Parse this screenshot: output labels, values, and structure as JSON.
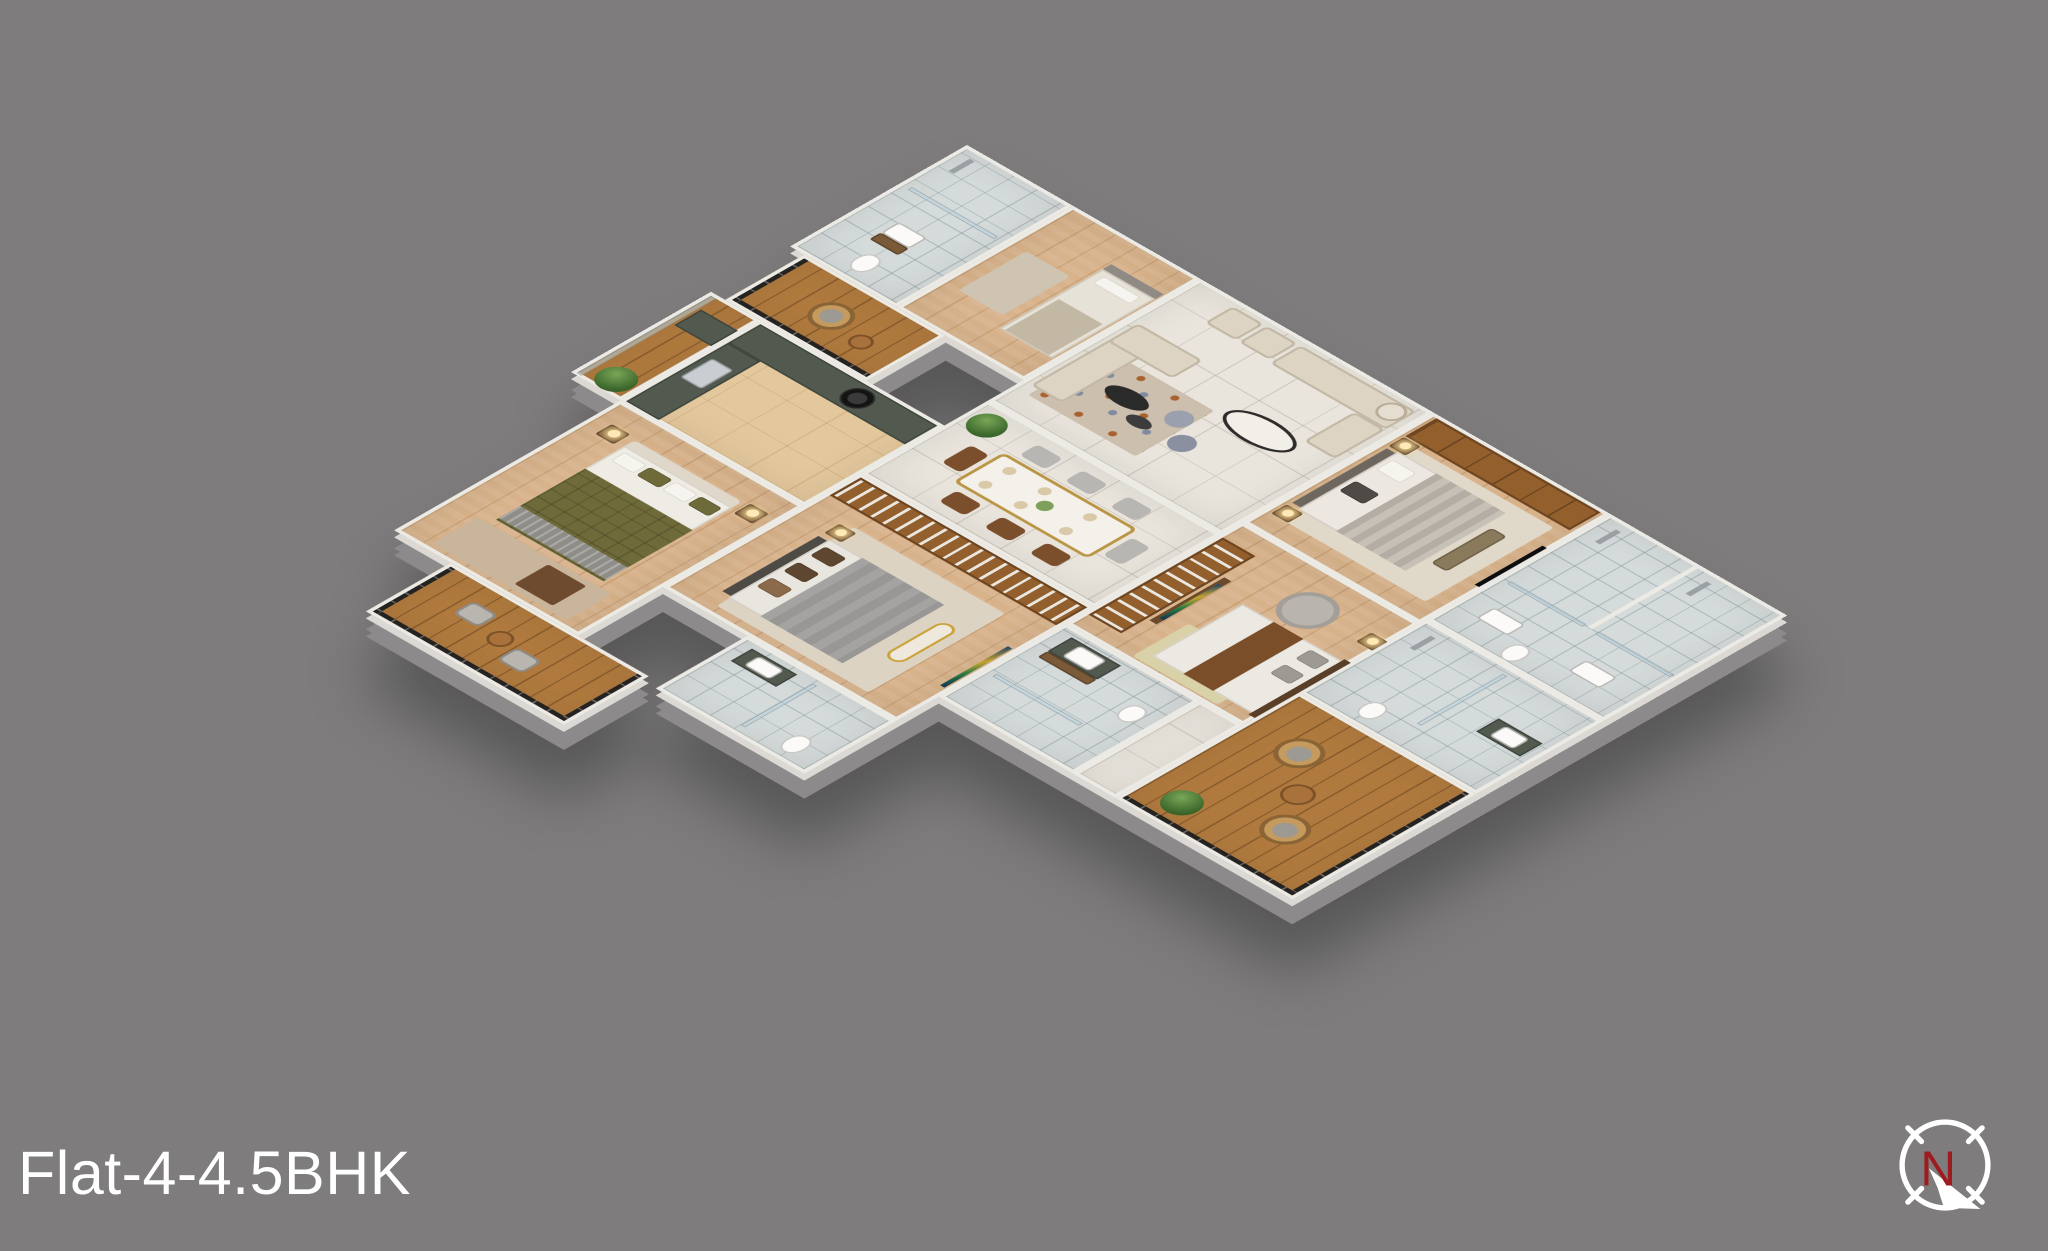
{
  "canvas": {
    "width": 2048,
    "height": 1251,
    "background": "#7e7c7d"
  },
  "title": {
    "text": "Flat-4-4.5BHK",
    "color": "#ffffff"
  },
  "compass": {
    "label": "N",
    "label_color": "#9e1b20",
    "ring_color": "#ffffff",
    "arrow_direction": "south-east"
  },
  "palette": {
    "wall": "#eceae5",
    "slab_edge": "#8d8a8c",
    "marble_floor": "#e9e5dd",
    "bathroom_tile": "#d5dbdb",
    "bedroom_wood": "#d7b28a",
    "balcony_deck": "#b07a3e",
    "kitchen_marble": "#e4c89d",
    "wardrobe_wood": "#935f2c",
    "granite_counter": "#525a50",
    "sofa_cream": "#ddd4c4",
    "accent_orange": "#a8622f",
    "olive_duvet": "#6f6a39",
    "gray_duvet": "#a4a3a1",
    "railing": "#242322"
  },
  "scene": {
    "type": "isometric-3d-floor-plan",
    "rooms": [
      {
        "id": "bathroom-1",
        "floor": "tile",
        "features": [
          "shower",
          "washbasin",
          "toilet"
        ]
      },
      {
        "id": "maid-room",
        "floor": "wood",
        "features": [
          "single-bed"
        ]
      },
      {
        "id": "sitout-balcony",
        "floor": "deck",
        "features": [
          "rattan-chair",
          "round-table",
          "black-railing"
        ]
      },
      {
        "id": "living-room",
        "floor": "marble",
        "features": [
          "sofa-set",
          "oval-coffee-table",
          "poufs",
          "rug",
          "armchairs"
        ]
      },
      {
        "id": "bedroom-1",
        "floor": "wood",
        "features": [
          "wardrobe",
          "double-bed",
          "bench",
          "nightstands",
          "tv"
        ]
      },
      {
        "id": "bathroom-2",
        "floor": "tile",
        "features": [
          "two-stalls",
          "showers",
          "washbasins",
          "toilet"
        ]
      },
      {
        "id": "utility-balcony",
        "floor": "deck",
        "features": [
          "granite-counter",
          "glass-rail"
        ]
      },
      {
        "id": "kitchen",
        "floor": "kitchen-marble",
        "features": [
          "l-counter",
          "gas-hob",
          "sink"
        ]
      },
      {
        "id": "dining",
        "floor": "marble",
        "features": [
          "eight-seat-table",
          "place-settings",
          "potted-plant"
        ]
      },
      {
        "id": "bedroom-2",
        "floor": "wood",
        "features": [
          "walk-in-closet",
          "tv",
          "round-daybed",
          "double-bed"
        ]
      },
      {
        "id": "bathroom-3",
        "floor": "tile",
        "features": [
          "vanity",
          "shower",
          "toilet"
        ]
      },
      {
        "id": "balcony-right",
        "floor": "deck",
        "features": [
          "rattan-chairs",
          "round-table",
          "plant",
          "black-railing"
        ]
      },
      {
        "id": "bathroom-5",
        "floor": "tile",
        "features": [
          "vanity",
          "toilet"
        ]
      },
      {
        "id": "foyer",
        "floor": "marble",
        "features": []
      },
      {
        "id": "bedroom-4",
        "floor": "wood",
        "features": [
          "closet-wall",
          "double-bed",
          "bench",
          "tv"
        ]
      },
      {
        "id": "bathroom-4",
        "floor": "tile",
        "features": [
          "vanity",
          "toilet"
        ]
      },
      {
        "id": "bedroom-3",
        "floor": "wood",
        "features": [
          "olive-quilt-bed",
          "nightstands",
          "lamps",
          "rug"
        ]
      },
      {
        "id": "balcony-bottom",
        "floor": "deck",
        "features": [
          "chairs",
          "round-table",
          "black-railing"
        ]
      }
    ]
  }
}
